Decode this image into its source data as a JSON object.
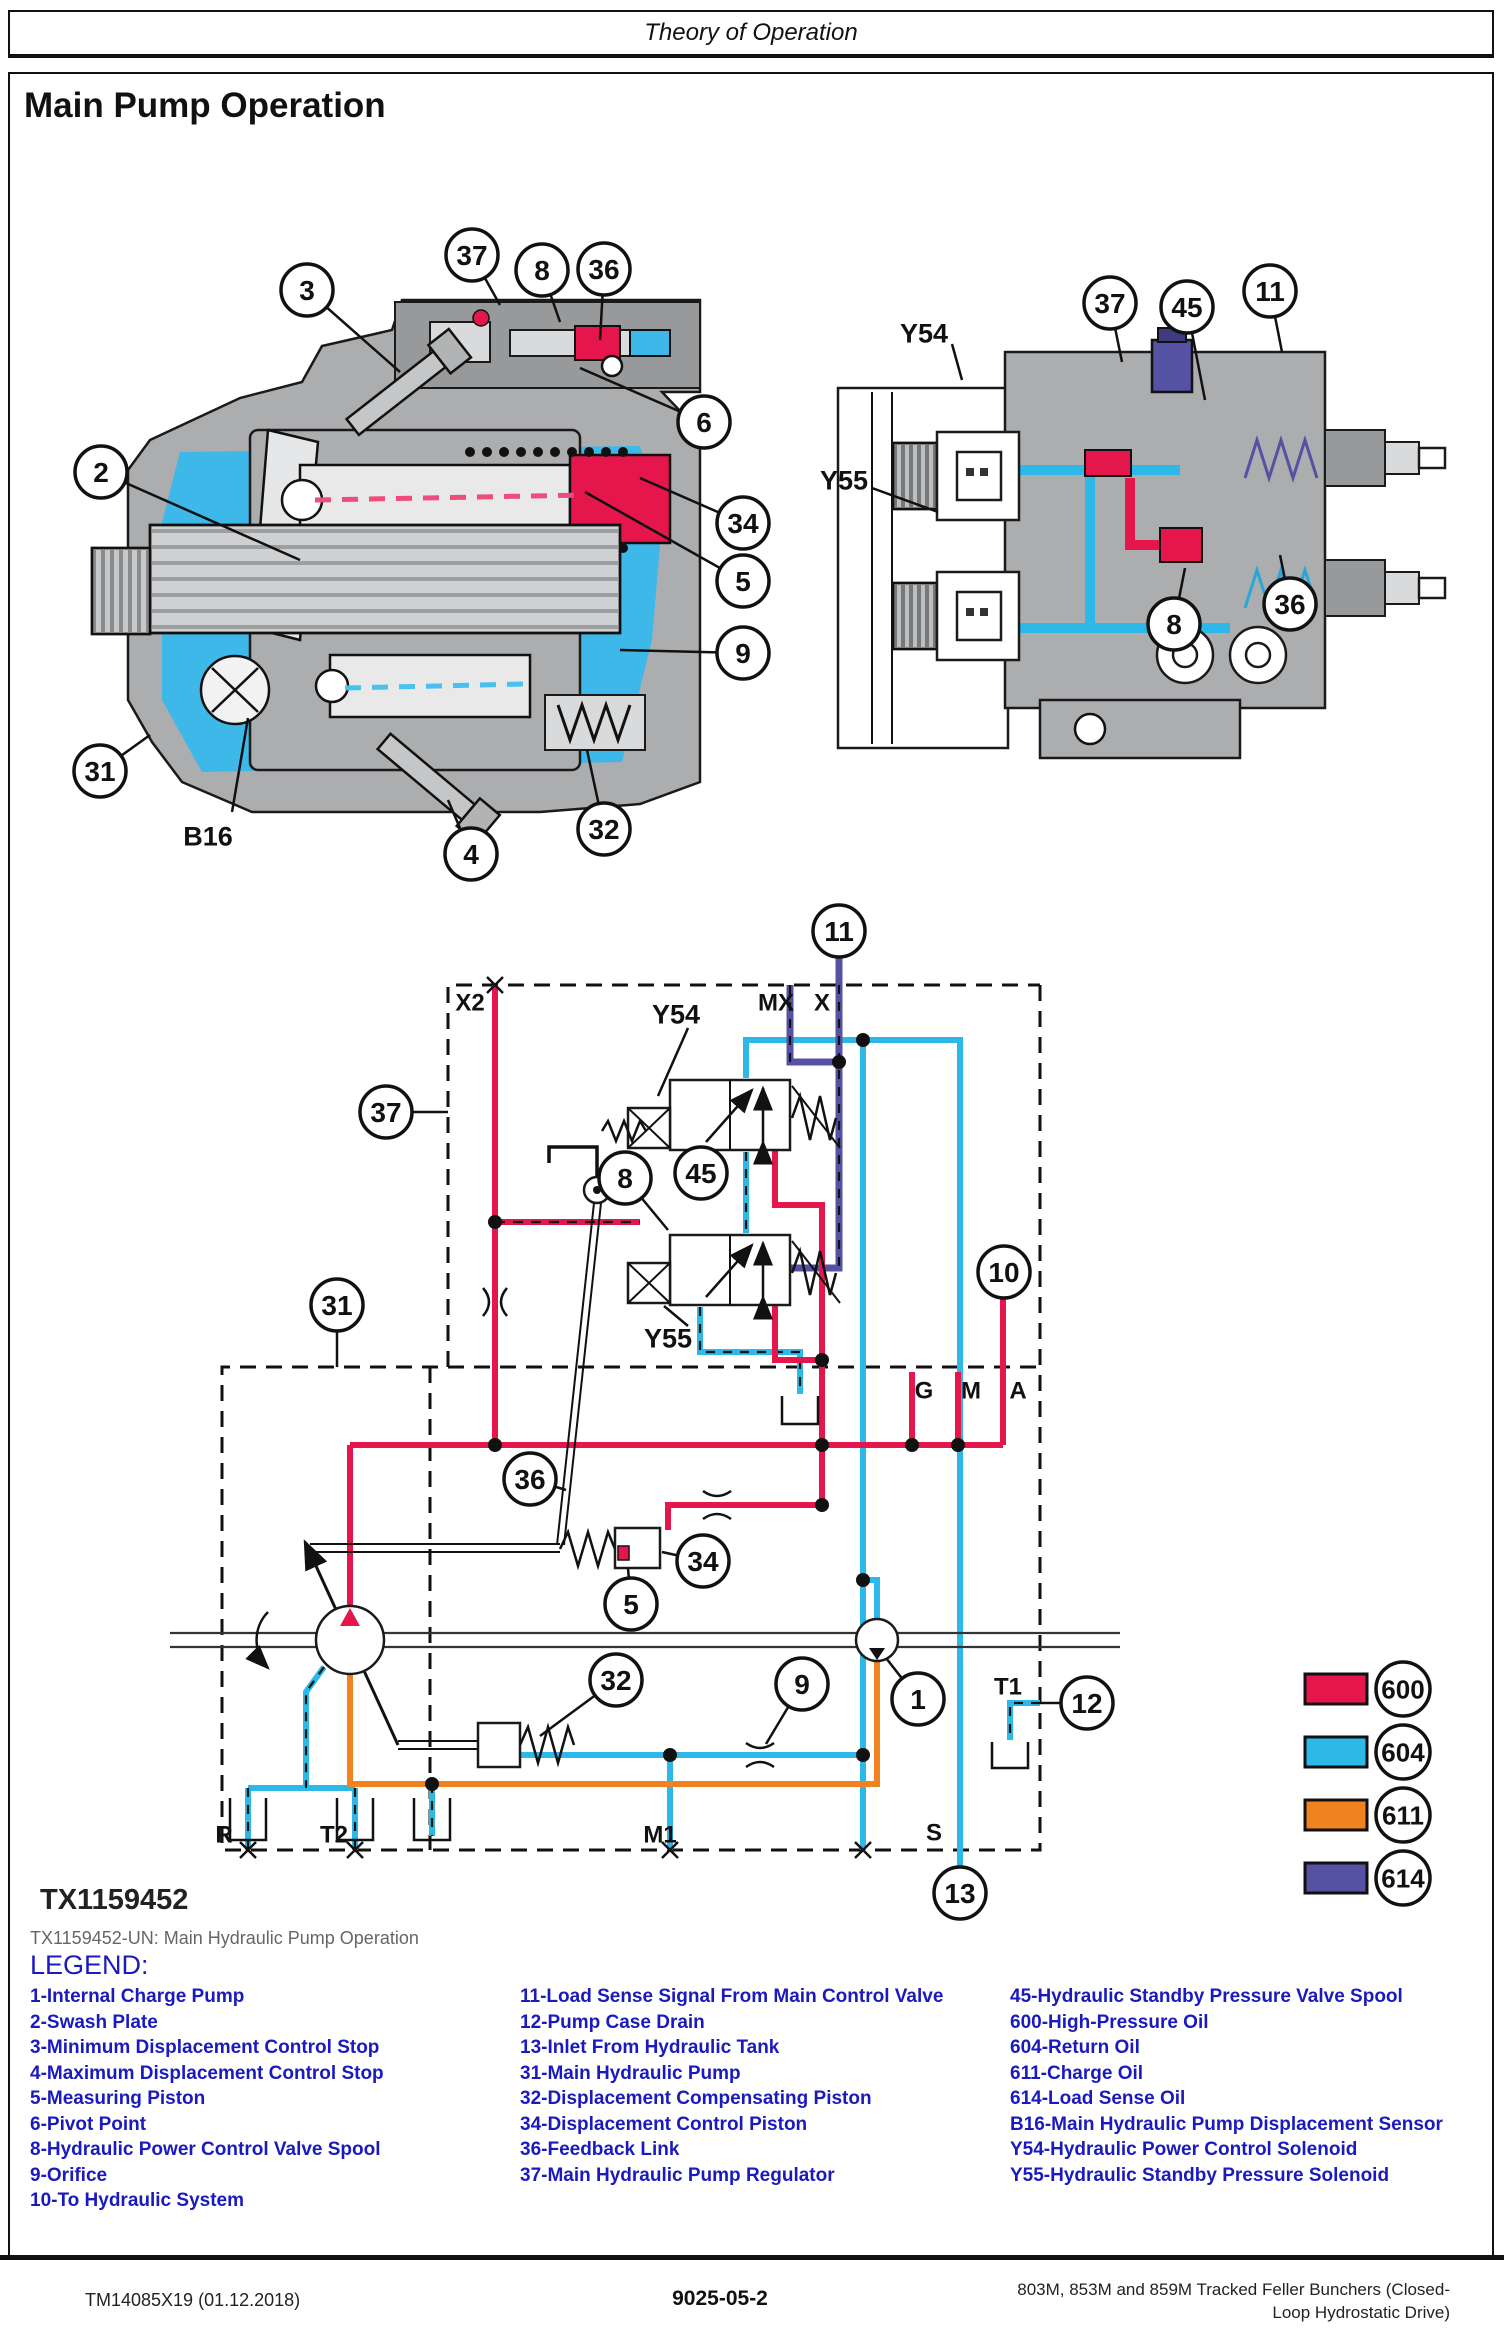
{
  "page": {
    "header_title": "Theory of Operation",
    "section_title": "Main Pump Operation",
    "figure_id": "TX1159452",
    "figure_caption": "TX1159452-UN: Main Hydraulic Pump Operation",
    "footer": {
      "left": "TM14085X19 (01.12.2018)",
      "center": "9025-05-2",
      "right_line1": "803M, 853M and 859M Tracked Feller Bunchers (Closed-",
      "right_line2": "Loop Hydrostatic Drive)"
    }
  },
  "colors": {
    "oil_600": "#E4164B",
    "oil_604": "#2CB9E9",
    "oil_611": "#F08220",
    "oil_614": "#5551A3",
    "legend_blue": "#1A1ABF",
    "caption_gray": "#666666",
    "body_gray": "#ACADAF",
    "body_gray_dark": "#98999B",
    "body_gray_light": "#D9DADB",
    "interior_cyan": "#3EB8E8"
  },
  "legend": {
    "heading": "LEGEND:",
    "col1": [
      "1-Internal Charge Pump",
      "2-Swash Plate",
      "3-Minimum Displacement Control Stop",
      "4-Maximum Displacement Control Stop",
      "5-Measuring Piston",
      "6-Pivot Point",
      "8-Hydraulic Power Control Valve Spool",
      "9-Orifice",
      "10-To Hydraulic System"
    ],
    "col2": [
      "11-Load Sense Signal From Main Control Valve",
      "12-Pump Case Drain",
      "13-Inlet From Hydraulic Tank",
      "31-Main Hydraulic Pump",
      "32-Displacement Compensating Piston",
      "34-Displacement Control Piston",
      "36-Feedback Link",
      "37-Main Hydraulic Pump Regulator"
    ],
    "col3": [
      "45-Hydraulic Standby Pressure Valve Spool",
      "600-High-Pressure Oil",
      "604-Return Oil",
      "611-Charge Oil",
      "614-Load Sense Oil",
      "B16-Main Hydraulic Pump Displacement Sensor",
      "Y54-Hydraulic Power Control Solenoid",
      "Y55-Hydraulic Standby Pressure Solenoid"
    ]
  },
  "swatches": [
    {
      "id": "600",
      "color": "#E4164B",
      "x": 1305,
      "y": 1674
    },
    {
      "id": "604",
      "color": "#2CB9E9",
      "x": 1305,
      "y": 1737
    },
    {
      "id": "611",
      "color": "#F08220",
      "x": 1305,
      "y": 1800
    },
    {
      "id": "614",
      "color": "#5551A3",
      "x": 1305,
      "y": 1863
    }
  ],
  "figure": {
    "callouts": [
      {
        "n": "3",
        "x": 307,
        "y": 290,
        "tx": 400,
        "ty": 372
      },
      {
        "n": "37",
        "x": 472,
        "y": 255,
        "tx": 500,
        "ty": 305
      },
      {
        "n": "8",
        "x": 542,
        "y": 270,
        "tx": 560,
        "ty": 322
      },
      {
        "n": "36",
        "x": 604,
        "y": 269,
        "tx": 600,
        "ty": 340
      },
      {
        "n": "6",
        "x": 704,
        "y": 422,
        "tx": 580,
        "ty": 368
      },
      {
        "n": "2",
        "x": 101,
        "y": 472,
        "tx": 300,
        "ty": 560
      },
      {
        "n": "34",
        "x": 743,
        "y": 523,
        "tx": 640,
        "ty": 478
      },
      {
        "n": "5",
        "x": 743,
        "y": 581,
        "tx": 585,
        "ty": 492
      },
      {
        "n": "9",
        "x": 743,
        "y": 653,
        "tx": 620,
        "ty": 650
      },
      {
        "n": "31",
        "x": 100,
        "y": 771,
        "tx": 150,
        "ty": 735
      },
      {
        "n": "4",
        "x": 471,
        "y": 854,
        "tx": 448,
        "ty": 800
      },
      {
        "n": "32",
        "x": 604,
        "y": 829,
        "tx": 587,
        "ty": 750
      },
      {
        "n": "37",
        "x": 1110,
        "y": 303,
        "tx": 1122,
        "ty": 362
      },
      {
        "n": "45",
        "x": 1187,
        "y": 307,
        "tx": 1205,
        "ty": 400
      },
      {
        "n": "11",
        "x": 1270,
        "y": 291,
        "tx": 1282,
        "ty": 352
      },
      {
        "n": "8",
        "x": 1174,
        "y": 624,
        "tx": 1185,
        "ty": 568
      },
      {
        "n": "36",
        "x": 1290,
        "y": 604,
        "tx": 1280,
        "ty": 555
      },
      {
        "n": "11",
        "x": 839,
        "y": 931
      },
      {
        "n": "37",
        "x": 386,
        "y": 1112,
        "tx": 448,
        "ty": 1112
      },
      {
        "n": "8",
        "x": 625,
        "y": 1178,
        "tx": 668,
        "ty": 1230
      },
      {
        "n": "45",
        "x": 701,
        "y": 1173,
        "tx": 712,
        "ty": 1152
      },
      {
        "n": "31",
        "x": 337,
        "y": 1305,
        "tx": 337,
        "ty": 1367
      },
      {
        "n": "10",
        "x": 1004,
        "y": 1272
      },
      {
        "n": "36",
        "x": 530,
        "y": 1479,
        "tx": 566,
        "ty": 1490
      },
      {
        "n": "34",
        "x": 703,
        "y": 1561,
        "tx": 662,
        "ty": 1552
      },
      {
        "n": "5",
        "x": 631,
        "y": 1604,
        "tx": 628,
        "ty": 1568
      },
      {
        "n": "32",
        "x": 616,
        "y": 1680,
        "tx": 540,
        "ty": 1736
      },
      {
        "n": "9",
        "x": 802,
        "y": 1684,
        "tx": 766,
        "ty": 1744
      },
      {
        "n": "1",
        "x": 918,
        "y": 1699,
        "tx": 886,
        "ty": 1658
      },
      {
        "n": "12",
        "x": 1087,
        "y": 1703,
        "tx": 1040,
        "ty": 1703
      },
      {
        "n": "13",
        "x": 960,
        "y": 1893
      }
    ],
    "labels": [
      {
        "text": "B16",
        "x": 208,
        "y": 836,
        "size": 27,
        "tx": 232,
        "ty": 812,
        "tx2": 248,
        "ty2": 718
      },
      {
        "text": "Y54",
        "x": 924,
        "y": 333,
        "size": 27,
        "tx": 952,
        "ty": 344,
        "tx2": 962,
        "ty2": 380
      },
      {
        "text": "Y55",
        "x": 844,
        "y": 480,
        "size": 27,
        "tx": 872,
        "ty": 488,
        "tx2": 938,
        "ty2": 512
      },
      {
        "text": "Y54",
        "x": 676,
        "y": 1014,
        "size": 27,
        "tx": 688,
        "ty": 1028,
        "tx2": 658,
        "ty2": 1096
      },
      {
        "text": "Y55",
        "x": 668,
        "y": 1338,
        "size": 27,
        "tx": 688,
        "ty": 1326,
        "tx2": 664,
        "ty2": 1306
      },
      {
        "text": "X2",
        "x": 470,
        "y": 1002,
        "size": 24
      },
      {
        "text": "MX",
        "x": 776,
        "y": 1002,
        "size": 24
      },
      {
        "text": "X",
        "x": 822,
        "y": 1002,
        "size": 24
      },
      {
        "text": "G",
        "x": 924,
        "y": 1390,
        "size": 24
      },
      {
        "text": "M",
        "x": 971,
        "y": 1390,
        "size": 24
      },
      {
        "text": "A",
        "x": 1018,
        "y": 1390,
        "size": 24
      },
      {
        "text": "T1",
        "x": 1008,
        "y": 1686,
        "size": 24
      },
      {
        "text": "R",
        "x": 224,
        "y": 1834,
        "size": 24
      },
      {
        "text": "T2",
        "x": 334,
        "y": 1834,
        "size": 24
      },
      {
        "text": "M1",
        "x": 660,
        "y": 1834,
        "size": 24
      },
      {
        "text": "S",
        "x": 934,
        "y": 1832,
        "size": 24
      }
    ]
  }
}
